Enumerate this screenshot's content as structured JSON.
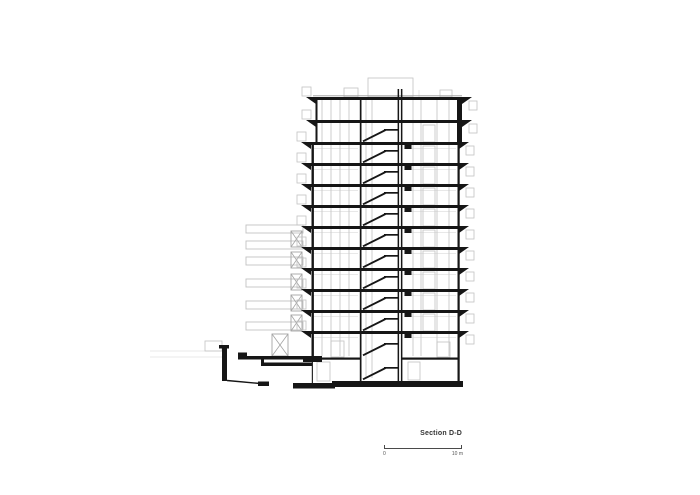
{
  "title": "Section D-D",
  "scale_bar": {
    "zero": "0",
    "max": "10 m"
  },
  "drawing": {
    "colors": {
      "ink": "#161616",
      "mid": "#999999",
      "light": "#c2c2c2",
      "faint": "#e0e0e0",
      "xbox": "#a5a5a5"
    },
    "slabs_y": [
      97,
      120,
      142,
      163,
      184,
      205,
      226,
      247,
      268,
      289,
      310,
      331
    ],
    "slab_h": 3,
    "top_span": [
      316,
      462
    ],
    "low_span": [
      311,
      459
    ],
    "tri": {
      "w": 10,
      "h": 7
    },
    "stair": {
      "x1": 363,
      "x2": 384,
      "wall_x": 398,
      "lower_ys": [
        142,
        163,
        184,
        205,
        226,
        247,
        268,
        289,
        310,
        331,
        356,
        380
      ]
    },
    "walls": [
      [
        315.5,
        97,
        142,
        2.0
      ],
      [
        311.5,
        142,
        358,
        2.4
      ],
      [
        311.8,
        358,
        383,
        1.1
      ],
      [
        359.8,
        97,
        382,
        1.7
      ],
      [
        397.6,
        89,
        383,
        1.5
      ],
      [
        400.9,
        89,
        383,
        1.5
      ],
      [
        457,
        97,
        142,
        5.0
      ],
      [
        457.5,
        142,
        381,
        2.2
      ]
    ],
    "vlines_light": [
      [
        322,
        100,
        356
      ],
      [
        331,
        100,
        356
      ],
      [
        340,
        100,
        356
      ],
      [
        349,
        100,
        356
      ],
      [
        366,
        100,
        378
      ],
      [
        372,
        100,
        378
      ],
      [
        413,
        100,
        356
      ],
      [
        421,
        100,
        356
      ],
      [
        437,
        100,
        356
      ],
      [
        449,
        100,
        356
      ]
    ],
    "bg_bars_y": [
      225,
      241,
      257,
      279,
      301,
      322
    ],
    "bg_bar": {
      "x": 246,
      "w": 57,
      "h": 8
    },
    "xboxes": [
      [
        291,
        231
      ],
      [
        291,
        252
      ],
      [
        291,
        274
      ],
      [
        291,
        295
      ],
      [
        291,
        315
      ]
    ],
    "xbox": {
      "w": 11,
      "h": 16
    },
    "ground_xbox": [
      272,
      334,
      16,
      22
    ],
    "blocks": [
      [
        222,
        346,
        5,
        35
      ],
      [
        219,
        345,
        10,
        3.5
      ],
      [
        238,
        352.5,
        9,
        7
      ],
      [
        238,
        356,
        74,
        3.5
      ],
      [
        261,
        356,
        3,
        10
      ],
      [
        262,
        362.5,
        50,
        3.5
      ],
      [
        303,
        356,
        19,
        6
      ],
      [
        322,
        357.5,
        38,
        2.2
      ],
      [
        402,
        357.5,
        56,
        2.2
      ],
      [
        258,
        381.5,
        11,
        4.5
      ],
      [
        293,
        383,
        42,
        5.5
      ],
      [
        332,
        381,
        131,
        6
      ]
    ],
    "ink_lines": [
      [
        227,
        380.5,
        260,
        383.5,
        1.4
      ]
    ],
    "mid_lines": [
      [
        313,
        95.8,
        462,
        95.8,
        0.8
      ]
    ],
    "faint_rects": [
      [
        368,
        78,
        45,
        19
      ],
      [
        344,
        88,
        14,
        9
      ],
      [
        440,
        90,
        12,
        7
      ],
      [
        205,
        341,
        17,
        10
      ],
      [
        317,
        362,
        13,
        19
      ],
      [
        408,
        362,
        12,
        18
      ],
      [
        437,
        342,
        13,
        15
      ],
      [
        331,
        341,
        13,
        16
      ]
    ],
    "faint_lines": [
      [
        150,
        351,
        224,
        351,
        0.8
      ],
      [
        150,
        357,
        222,
        357,
        0.8
      ],
      [
        419,
        90,
        419,
        97,
        0.8
      ]
    ]
  }
}
